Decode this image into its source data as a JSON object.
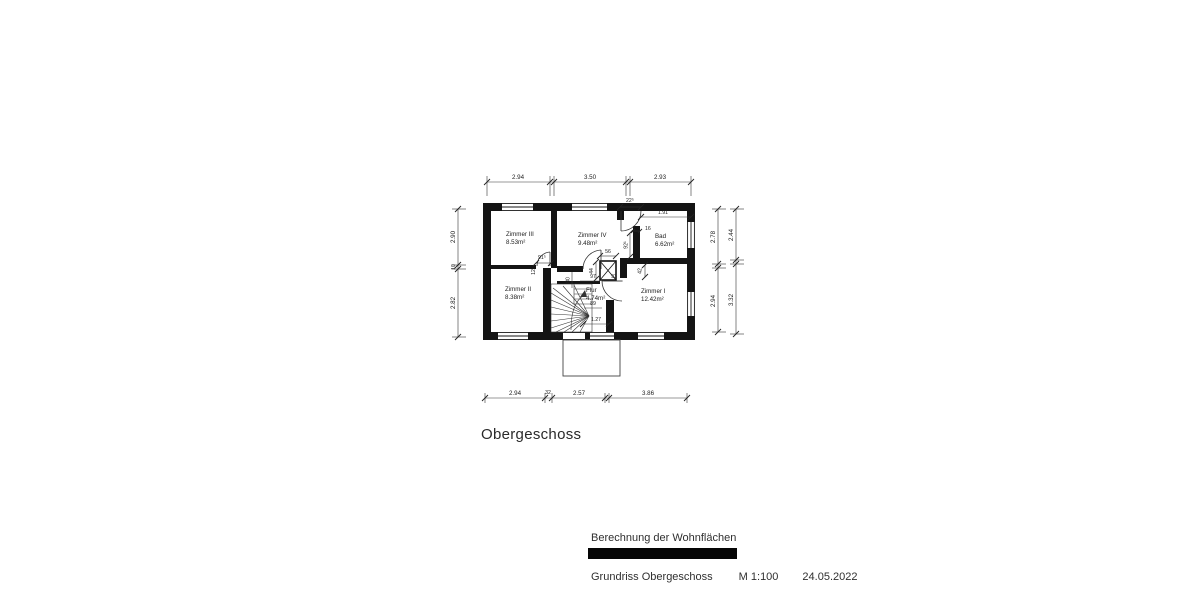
{
  "plan": {
    "floor_label": "Obergeschoss",
    "rooms": [
      {
        "name": "Zimmer III",
        "area": "8.53m²"
      },
      {
        "name": "Zimmer IV",
        "area": "9.48m²"
      },
      {
        "name": "Bad",
        "area": "6.62m²"
      },
      {
        "name": "Zimmer II",
        "area": "8.38m²"
      },
      {
        "name": "Flur",
        "area": "4.74m²"
      },
      {
        "name": "Zimmer I",
        "area": "12.42m²"
      }
    ],
    "dims": {
      "top": [
        "2.94",
        "3.50",
        "2.93"
      ],
      "bottom": [
        "2.94",
        "32",
        "2.57",
        "3.86"
      ],
      "left": [
        "2.90",
        "10",
        "2.82"
      ],
      "right_inner": [
        "2.78",
        "2.94"
      ],
      "right_outer": [
        "2.44",
        "3.32"
      ],
      "inner": {
        "bad_door": "22⁵",
        "bad_width": "1.91",
        "bad_wall": "16",
        "bad_depth": "92¹",
        "shaft_width": "56",
        "shaft_depth": "44",
        "step": "42",
        "vestibule_left": "97",
        "vestibule_right": "93",
        "flur_side": "80",
        "flur_width": "89",
        "flur_length": "1.27",
        "door_zimmer3": "91⁵",
        "door_sill": "12"
      }
    }
  },
  "titleblock": {
    "calc_label": "Berechnung der Wohnflächen",
    "drawing_label": "Grundriss Obergeschoss",
    "scale": "M 1:100",
    "date": "24.05.2022"
  }
}
